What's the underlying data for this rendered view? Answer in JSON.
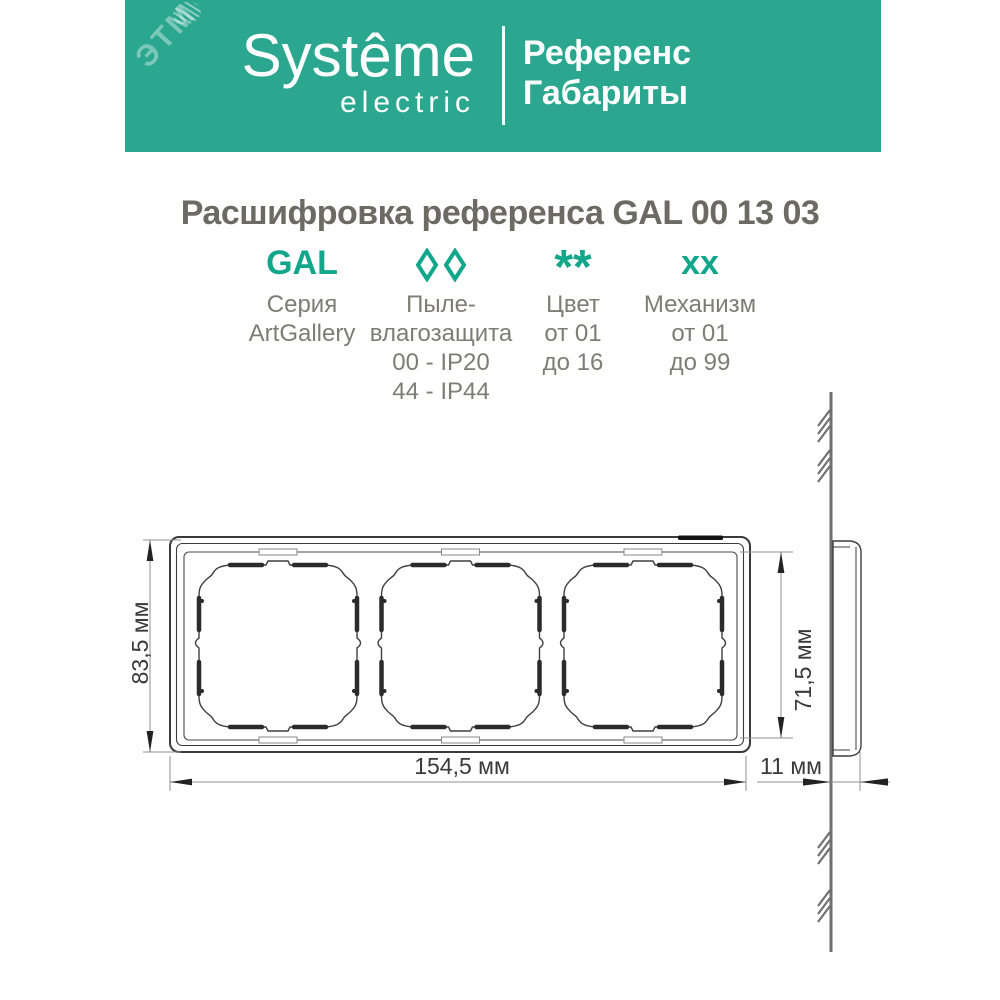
{
  "header": {
    "band_color": "#2aa78e",
    "brand_line1": "Systême",
    "brand_line2": "electric",
    "doc_type_line1": "Референс",
    "doc_type_line2": "Габариты",
    "watermark": "ЭТМ"
  },
  "title": "Расшифровка референса GAL 00 13 03",
  "accent_color": "#12a68a",
  "reference_breakdown": [
    {
      "symbol": "GAL",
      "lines": [
        "Серия",
        "ArtGallery"
      ]
    },
    {
      "symbol": "◊◊",
      "lines": [
        "Пыле-",
        "влагозащита",
        "00 - IP20",
        "44 - IP44"
      ]
    },
    {
      "symbol": "**",
      "lines": [
        "Цвет",
        "от 01",
        "до 16"
      ]
    },
    {
      "symbol": "xx",
      "lines": [
        "Механизм",
        "от 01",
        "до 99"
      ]
    }
  ],
  "dimensions": {
    "height": "83,5 мм",
    "inner_height": "71,5 мм",
    "width": "154,5 мм",
    "depth": "11 мм"
  }
}
